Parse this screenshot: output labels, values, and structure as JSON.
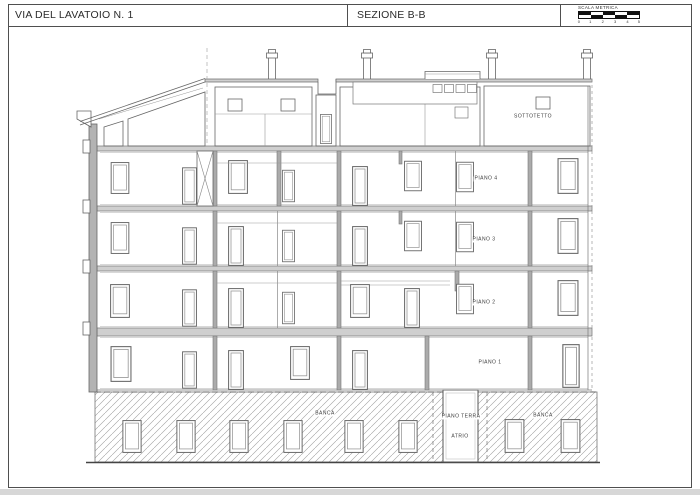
{
  "title_block": {
    "project_title": "VIA DEL LAVATOIO N. 1",
    "drawing_title": "SEZIONE B-B",
    "scale": {
      "label": "SCALA METRICA",
      "ticks": [
        "0",
        "1",
        "2",
        "3",
        "4",
        "5"
      ]
    }
  },
  "drawing": {
    "floor_labels": [
      {
        "id": "sottotetto",
        "text": "SOTTOTETTO"
      },
      {
        "id": "piano-4",
        "text": "PIANO 4"
      },
      {
        "id": "piano-3",
        "text": "PIANO 3"
      },
      {
        "id": "piano-2",
        "text": "PIANO 2"
      },
      {
        "id": "piano-1",
        "text": "PIANO 1"
      },
      {
        "id": "piano-terra",
        "text": "PIANO TERRA"
      },
      {
        "id": "atrio",
        "text": "ATRIO"
      },
      {
        "id": "banca-left",
        "text": "BANCA"
      },
      {
        "id": "banca-right",
        "text": "BANCA"
      }
    ]
  },
  "colors": {
    "line": "#5f5f5f",
    "wall_fill": "#ababab",
    "slab_fill": "#cfcfcf",
    "hatch": "#9f9f9f"
  }
}
